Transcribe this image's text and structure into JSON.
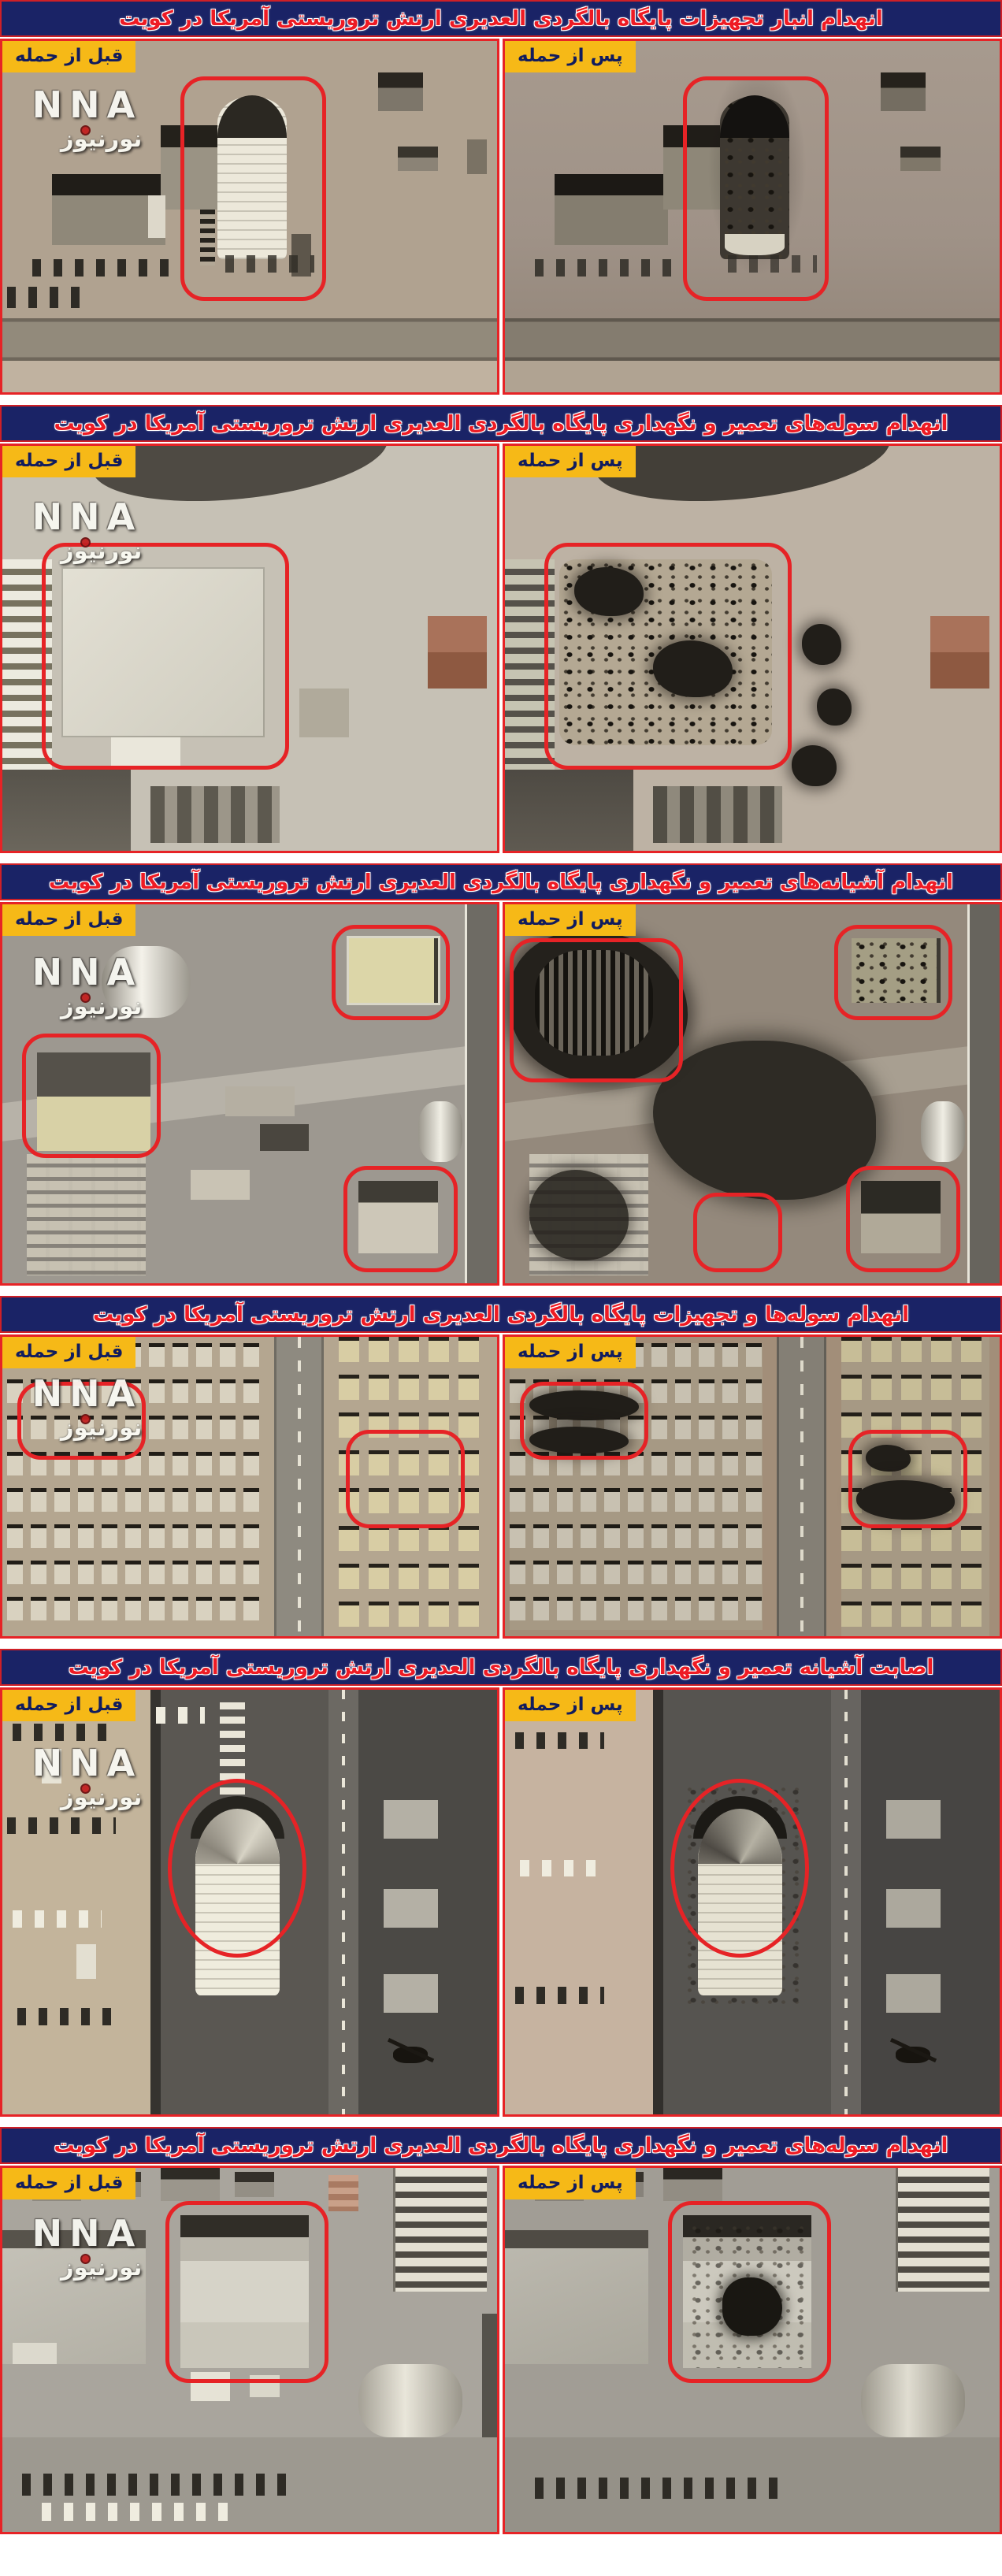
{
  "colors": {
    "header_bg": "#1a2366",
    "header_text": "#ee1b24",
    "label_bg": "#f6b917",
    "label_text": "#111c5e",
    "highlight": "#e62326"
  },
  "labels": {
    "before": "قبل از حمله",
    "after": "پس از حمله"
  },
  "watermark": {
    "nna": "NNA",
    "noornews": "نورنیوز"
  },
  "sections": [
    {
      "title": "انهدام انبار تجهیزات پایگاه بالگردی العدیری ارتش تروریستی آمریکا در کویت"
    },
    {
      "title": "انهدام سوله‌های تعمیر و نگهداری پایگاه بالگردی العدیری ارتش تروریستی آمریکا در کویت"
    },
    {
      "title": "انهدام آشیانه‌های تعمیر و نگهداری پایگاه بالگردی العدیری ارتش تروریستی آمریکا در کویت"
    },
    {
      "title": "انهدام سوله‌ها و تجهیزات پایگاه بالگردی العدیری ارتش تروریستی آمریکا در کویت"
    },
    {
      "title": "اصابت آشیانه تعمیر و نگهداری پایگاه بالگردی العدیری ارتش تروریستی آمریکا در کویت"
    },
    {
      "title": "انهدام سوله‌های تعمیر و نگهداری پایگاه بالگردی العدیری ارتش تروریستی آمریکا در کویت"
    }
  ]
}
